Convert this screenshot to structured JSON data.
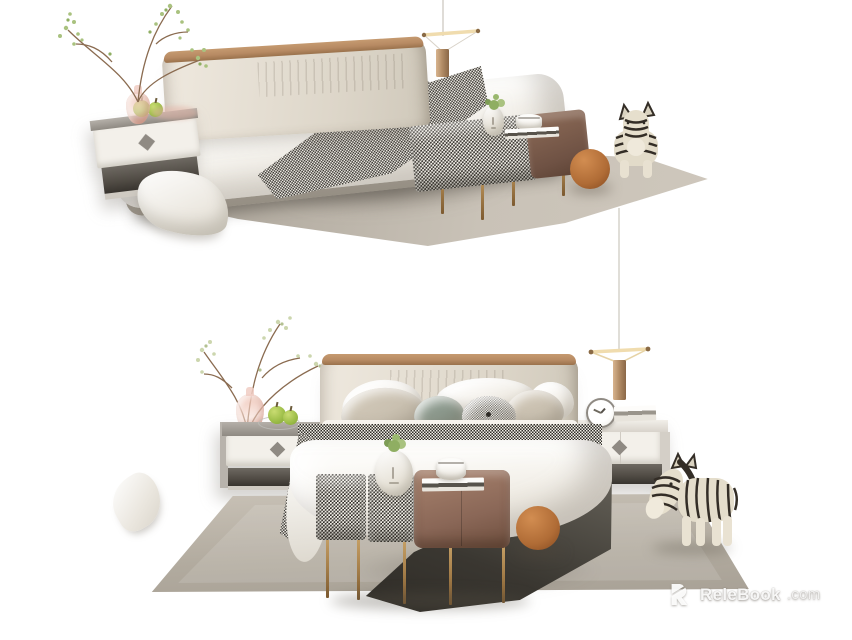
{
  "watermark": {
    "brand": "ReleBook",
    "suffix": ".com",
    "logo_icon": "relebook-r-icon"
  },
  "palette": {
    "background": "#ffffff",
    "rug_light": "#c9c2b7",
    "rug_dark": "#a8a196",
    "headboard": "#e9e2d7",
    "wood": "#b78a63",
    "leather": "#8a6757",
    "brass": "#a9824c",
    "ball": "#b06c36",
    "sage": "#8a978b",
    "beige": "#c9c0b0",
    "duvet": "#f8f5f0",
    "hnd_dark": "#2e2b26",
    "hnd_light": "#f3f0e9",
    "plant": "#a9c27f",
    "apple": "#9fbf4a",
    "shelf": "#504b44",
    "under_bed": "#3a3731",
    "panel": "#f3f0ea",
    "metal_gray": "#8f8a83"
  }
}
